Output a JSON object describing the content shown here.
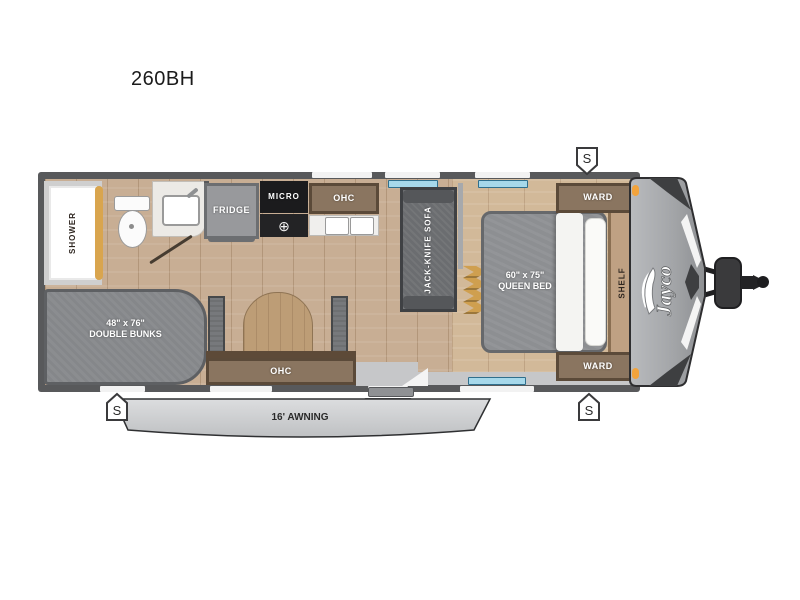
{
  "title": "260BH",
  "trailer": {
    "brand": "Jayco",
    "speaker_marker": "S",
    "awning_label": "16' AWNING"
  },
  "rooms": {
    "shower": "SHOWER",
    "fridge": "FRIDGE",
    "micro": "MICRO",
    "kitchen_ohc": "OHC",
    "dinette_ohc": "OHC",
    "sofa": "JACK-KNIFE SOFA",
    "queen_bed_size": "60\" x 75\"",
    "queen_bed_name": "QUEEN BED",
    "ward_front_top": "WARD",
    "ward_front_bottom": "WARD",
    "shelf": "SHELF",
    "bunks_size": "48\" x 76\"",
    "bunks_name": "DOUBLE BUNKS"
  },
  "icons": {
    "burner": "⊕"
  },
  "colors": {
    "wall": "#58595b",
    "floor_wood": "#c8ae94",
    "platform_wood": "#d2b999",
    "furniture_gray": "#85878a",
    "cabinet_brown": "#8a7560",
    "cabinet_trim": "#5b4a39",
    "appliance_black": "#1b1b1d",
    "cap_gray": "#a7a9ac",
    "accent_dark": "#3e3f41",
    "clearance_light": "#f2a33c",
    "window_blue": "#a6d8ea",
    "shower_door_tan": "#d9a54e",
    "awning_gray": "#ced0d2"
  }
}
